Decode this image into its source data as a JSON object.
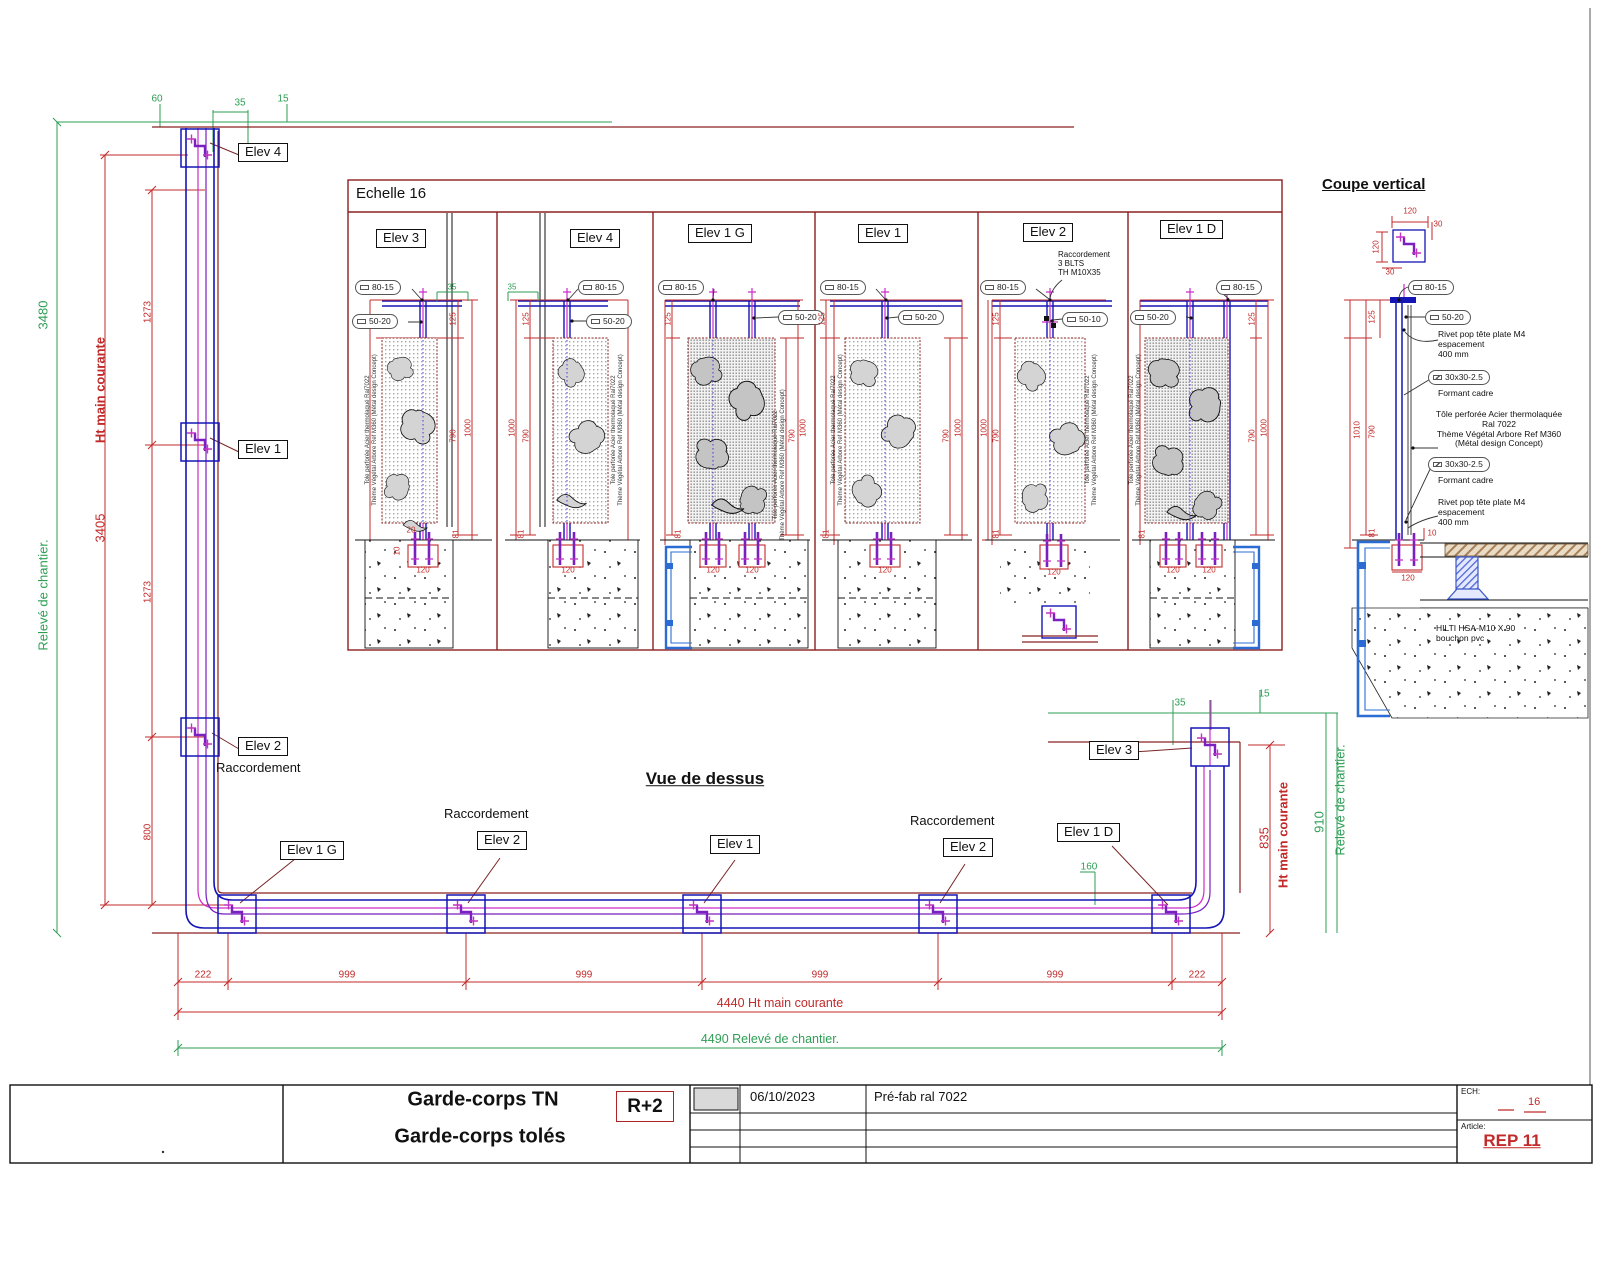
{
  "titles": {
    "echelle": "Echelle 16",
    "coupe": "Coupe vertical",
    "vue": "Vue de dessus"
  },
  "plan": {
    "top": {
      "d60": "60",
      "d35": "35",
      "d15": "15"
    },
    "left": {
      "releve": "Relevé de chantier.",
      "releve_val": "3480",
      "ht": "Ht main courante",
      "ht_val": "3405",
      "seg1": "1273",
      "seg2": "1273",
      "seg3": "800"
    },
    "right": {
      "d35": "35",
      "d15": "15",
      "d160": "160",
      "ht": "Ht main courante",
      "ht_val": "835",
      "releve": "Relevé de chantier.",
      "releve_val": "910"
    },
    "bottom": {
      "d222": "222",
      "d999": "999",
      "total_mc": "4440 Ht main courante",
      "total_rc": "4490  Relevé de chantier."
    },
    "labels": {
      "elev1": "Elev 1",
      "elev2": "Elev 2",
      "elev3": "Elev 3",
      "elev4": "Elev 4",
      "elev1g": "Elev 1 G",
      "elev1d": "Elev 1 D",
      "racc": "Raccordement"
    }
  },
  "ec": {
    "t80": "80-15",
    "t50": "50-20",
    "t50b": "50-10",
    "d35": "35",
    "d125": "125",
    "d790": "790",
    "d1000": "1000",
    "d81": "81",
    "d20": "20",
    "d10": "10",
    "d120": "120",
    "note": "Tole perforée Acier thermolaqué Ral7022\nThème Végétal Arbore Ref M360 (Métal design Concept)",
    "racc_note": "Raccordement\n3 BLTS\nTH M10X35"
  },
  "elevations": [
    {
      "name": "Elev 3"
    },
    {
      "name": "Elev 4"
    },
    {
      "name": "Elev 1 G"
    },
    {
      "name": "Elev 1"
    },
    {
      "name": "Elev 2"
    },
    {
      "name": "Elev 1 D"
    }
  ],
  "coupe": {
    "d120": "120",
    "d30": "30",
    "d125": "125",
    "d1010": "1010",
    "d790": "790",
    "d81": "81",
    "d10": "10",
    "rivet": "Rivet pop tête plate M4\nespacement\n400 mm",
    "cadre_tag": "30x30-2.5",
    "cadre": "Formant cadre",
    "tole": "Tôle perforée Acier thermolaquée\nRal 7022\nThème Végétal Arbore Ref M360\n(Métal design Concept)",
    "hilti": "HILTI HSA-M10 X 90\nbouchon pvc"
  },
  "tb": {
    "title1": "Garde-corps TN",
    "title2": "Garde-corps tolés",
    "level": "R+2",
    "date": "06/10/2023",
    "desc": "Pré-fab ral 7022",
    "ech_label": "ECH:",
    "ech": "16",
    "article_label": "Article:",
    "article": "REP 11"
  }
}
